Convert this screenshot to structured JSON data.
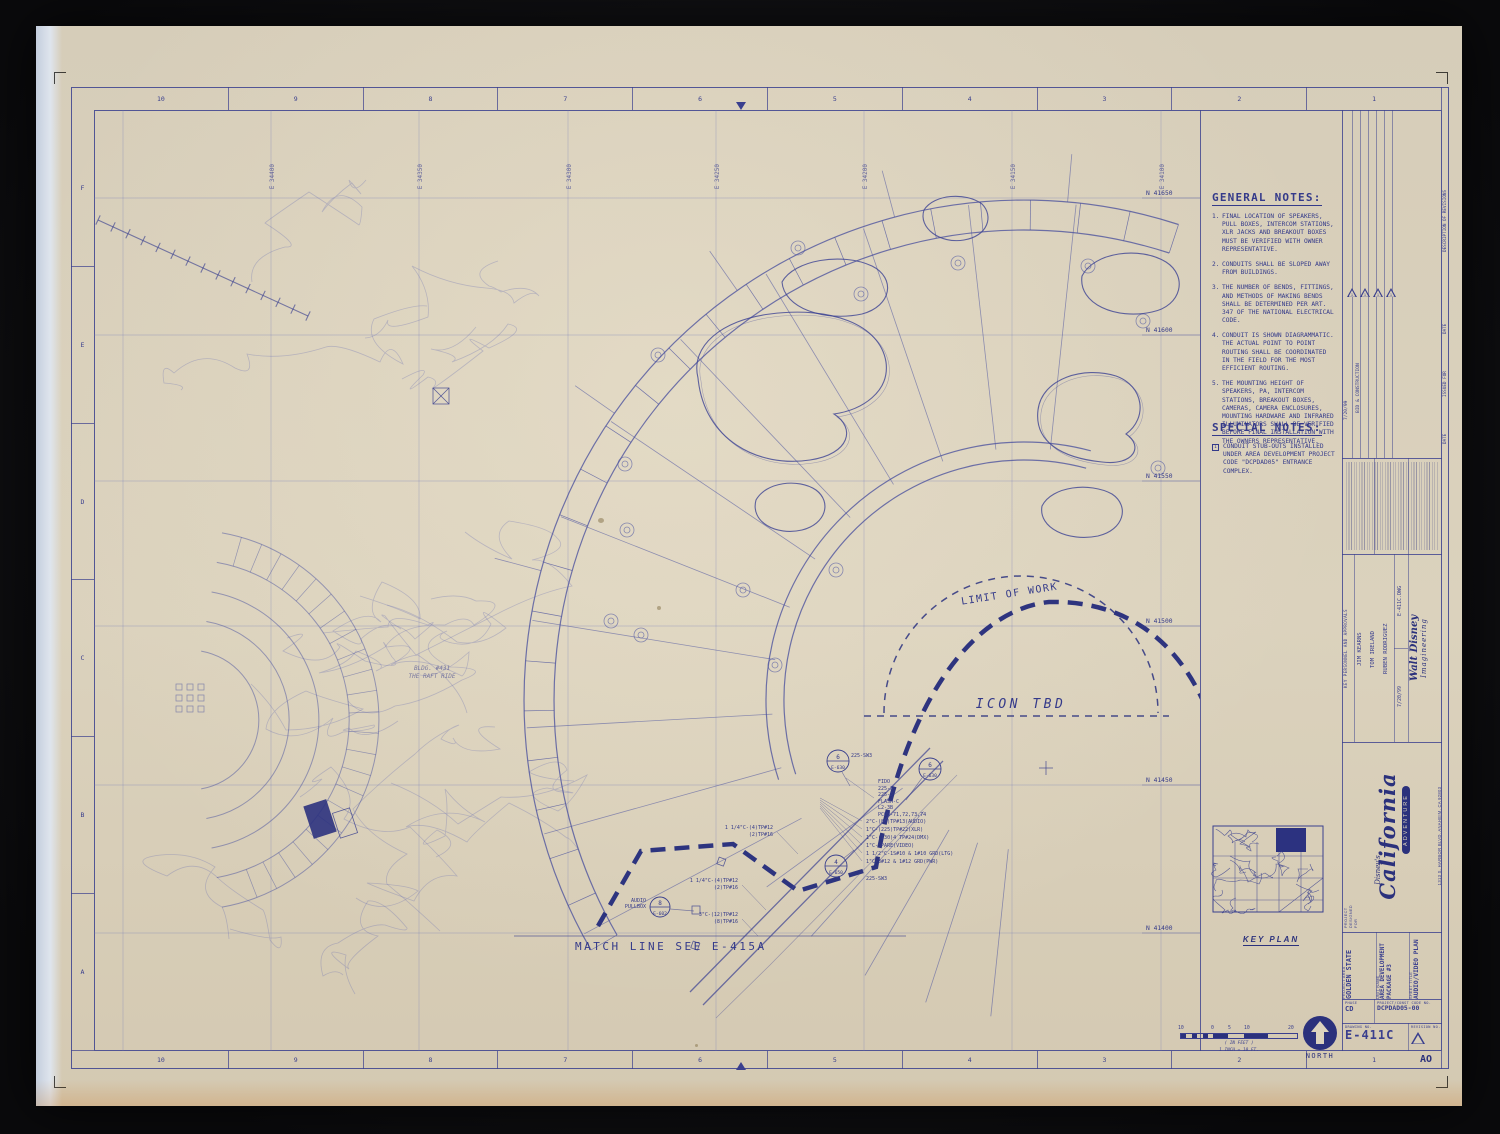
{
  "margin": {
    "top_numbers": [
      "10",
      "9",
      "8",
      "7",
      "6",
      "5",
      "4",
      "3",
      "2",
      "1"
    ],
    "bottom_numbers": [
      "10",
      "9",
      "8",
      "7",
      "6",
      "5",
      "4",
      "3",
      "2",
      "1"
    ],
    "left_letters": [
      "F",
      "E",
      "D",
      "C",
      "B",
      "A"
    ],
    "corner_label": "AO"
  },
  "coords": {
    "top": [
      "E 34400",
      "E 34350",
      "E 34300",
      "E 34250",
      "E 34200",
      "E 34150",
      "E 34100"
    ],
    "right": [
      "N 41650",
      "N 41600",
      "N 41550",
      "N 41500",
      "N 41450",
      "N 41400"
    ]
  },
  "general_notes": {
    "title": "GENERAL NOTES:",
    "items": [
      {
        "num": "1.",
        "text": "FINAL LOCATION OF SPEAKERS, PULL BOXES, INTERCOM STATIONS, XLR JACKS AND BREAKOUT BOXES MUST BE VERIFIED WITH OWNER REPRESENTATIVE."
      },
      {
        "num": "2.",
        "text": "CONDUITS SHALL BE SLOPED AWAY FROM BUILDINGS."
      },
      {
        "num": "3.",
        "text": "THE NUMBER OF BENDS, FITTINGS, AND METHODS OF MAKING BENDS SHALL BE DETERMINED PER ART. 347 OF THE NATIONAL ELECTRICAL CODE."
      },
      {
        "num": "4.",
        "text": "CONDUIT IS SHOWN DIAGRAMMATIC. THE ACTUAL POINT TO POINT ROUTING SHALL BE COORDINATED IN THE FIELD FOR THE MOST EFFICIENT ROUTING."
      },
      {
        "num": "5.",
        "text": "THE MOUNTING HEIGHT OF SPEAKERS, PA, INTERCOM STATIONS, BREAKOUT BOXES, CAMERAS, CAMERA ENCLOSURES, MOUNTING HARDWARE AND INFRARED ILLUMINATORS SHALL BE VERIFIED BEFORE FINAL INSTALLATION WITH THE OWNERS REPRESENTATIVE."
      }
    ]
  },
  "special_notes": {
    "title": "SPECIAL NOTES:",
    "items": [
      {
        "num": "1",
        "text": "CONDUIT STUB-OUTS INSTALLED UNDER AREA DEVELOPMENT PROJECT CODE \"DCPDAD05\" ENTRANCE COMPLEX."
      }
    ]
  },
  "drawing": {
    "match_line": "MATCH LINE   SEE   E-415A",
    "limit_of_work": "LIMIT OF WORK",
    "icon_tbd": "ICON TBD",
    "bldg_line1": "BLDG. #431",
    "bldg_line2": "THE RAFT RIDE",
    "bubble1_num": "6",
    "bubble1_tag": "E-630",
    "bubble2_num": "6",
    "bubble2_tag": "E-630",
    "bubble3_num": "4",
    "bubble3_tag": "E-650",
    "bubble4_num": "8",
    "bubble4_tag": "E-602",
    "sw_label_1": "225-SW3",
    "sw_label_2": "225-SW3",
    "equipment_list": [
      "FIDO",
      "225-3",
      "225-5",
      "FLASH-C",
      "L2-3B",
      "PCOM-71,72,73,74"
    ],
    "conduit_list": [
      "2\"C-(80)TP#13(AUDIO)",
      "1\"C-(225)TP#22(XLR)",
      "1\"C-(130)4 TP#24(DMX)",
      "1\"C-SPARE(VIDEO)",
      "1 1/2\"C-1S#10 & 1#10 GRD(LTG)",
      "1\"C-3#12 & 1#12 GRD(PWR)"
    ],
    "pullbox_line1": "AUDIO",
    "pullbox_line2": "PULLBOX",
    "riser_a1": "1 1/4\"C-(4)TP#12",
    "riser_a2": "(2)TP#16",
    "riser_b1": "1 1/4\"C-(4)TP#12",
    "riser_b2": "(2)TP#16",
    "riser_c1": "3\"C-(12)TP#12",
    "riser_c2": "(8)TP#16"
  },
  "key_plan": {
    "label": "KEY PLAN"
  },
  "scale_bar": {
    "ticks": [
      "10",
      "0",
      "5",
      "10",
      "20"
    ],
    "caption1": "( IN FEET )",
    "caption2": "1 INCH = 10 FT."
  },
  "north": {
    "label": "NORTH"
  },
  "revisions": {
    "description_header": "DESCRIPTION OF REVISIONS",
    "date_header_1": "DATE",
    "issued_header": "ISSUED FOR",
    "date_header_2": "DATE",
    "delta_marks": [
      "1",
      "1",
      "1",
      "1"
    ],
    "entry_text": "BID & CONSTRUCTION",
    "entry_date": "7/20/99"
  },
  "personnel": {
    "header": "KEY PERSONNEL AND APPROVALS",
    "names": [
      "JIM KEARNS",
      "TOM IRELAND",
      "RUBEN RODRIGUEZ"
    ],
    "date": "7/20/99",
    "file": "E-411C.DWG",
    "firm_line1": "Walt Disney",
    "firm_line2": "Imagineering"
  },
  "brand": {
    "designed_for": "PROJECT DESIGNED FOR",
    "script_small": "Disney's",
    "script_big": "California",
    "banner": "ADVENTURE",
    "address": "1313 S. HARBOR BLVD.  ANAHEIM, CA 92803"
  },
  "title_block": {
    "project_area_label": "PROJECT AREA",
    "project_area": "GOLDEN STATE",
    "unit_label": "UNIT NAME",
    "unit": "AREA DEVELOPMENT PACKAGE #3",
    "sheet_label": "SHEET TITLE",
    "sheet": "AUDIO/VIDEO PLAN",
    "phase_label": "PHASE",
    "phase": "CD",
    "code_label": "PROJECT/CONST CODE NO.",
    "code": "DCPDAD05-00",
    "drawing_label": "DRAWING NO.",
    "drawing_no": "E-411C",
    "revision_label": "REVISION NO."
  }
}
